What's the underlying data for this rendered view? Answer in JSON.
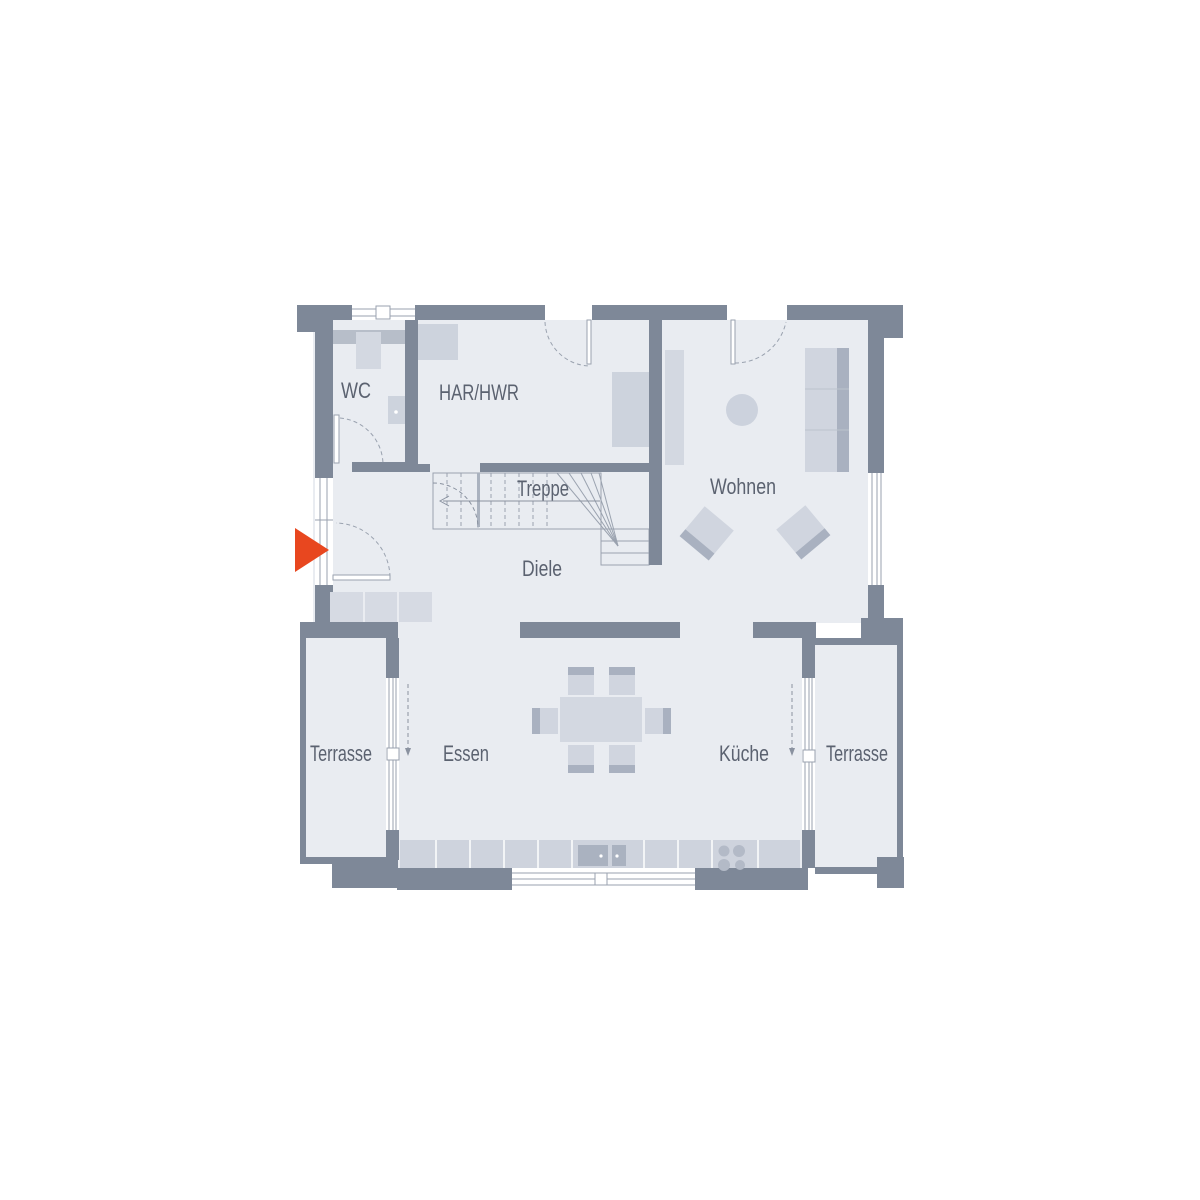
{
  "plan": {
    "rooms": {
      "wc": "WC",
      "har_hwr": "HAR/HWR",
      "treppe": "Treppe",
      "diele": "Diele",
      "wohnen": "Wohnen",
      "terrasse_left": "Terrasse",
      "essen": "Essen",
      "kueche": "Küche",
      "terrasse_right": "Terrasse"
    },
    "colors": {
      "background": "#ffffff",
      "wall": "#7e8898",
      "floor": "#e9ecf1",
      "furniture_light": "#d3d8e1",
      "furniture_mid": "#ced3dd",
      "furniture_dark": "#a9b1c0",
      "outline": "#9aa2af",
      "label": "#5b6270",
      "accent": "#e8471f"
    },
    "icons": {
      "entrance_arrow": "entrance-arrow"
    }
  }
}
